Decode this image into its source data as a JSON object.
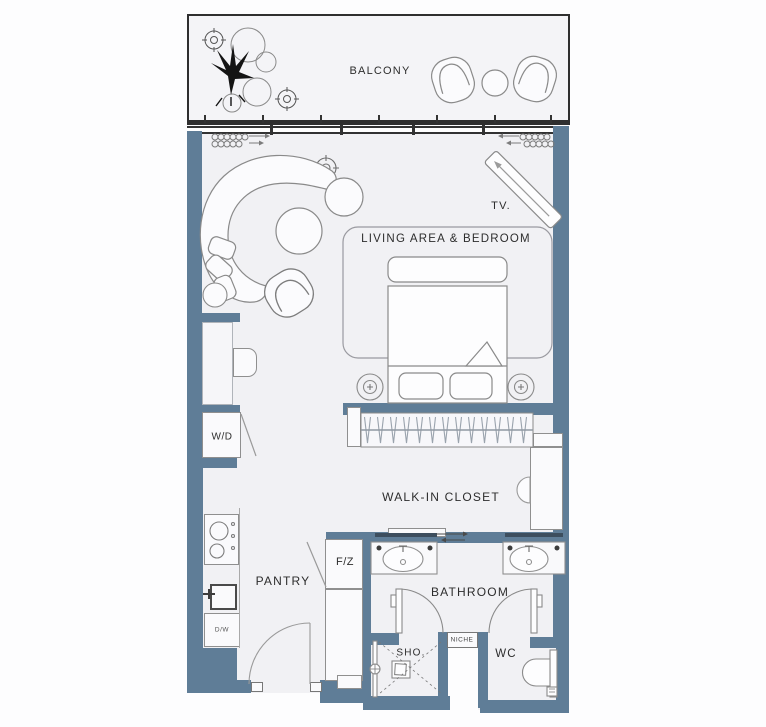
{
  "labels": {
    "balcony": "BALCONY",
    "tv": "TV.",
    "living": "LIVING AREA & BEDROOM",
    "wd": "W/D",
    "walk_in_closet": "WALK-IN CLOSET",
    "pantry": "PANTRY",
    "fz": "F/Z",
    "dw": "D/W",
    "bathroom": "BATHROOM",
    "sho": "SHO.",
    "niche": "NICHE",
    "wc": "WC"
  },
  "colors": {
    "wall": "#5f7d97",
    "floor": "#f1f1f4",
    "balcony_floor": "#f4f4f7",
    "furniture_line": "#8a8a8a",
    "dark_line": "#2f2f2f",
    "mirror_bar": "#3d4e5e",
    "text": "#2d2d2d",
    "background": "#fdfdfe"
  }
}
